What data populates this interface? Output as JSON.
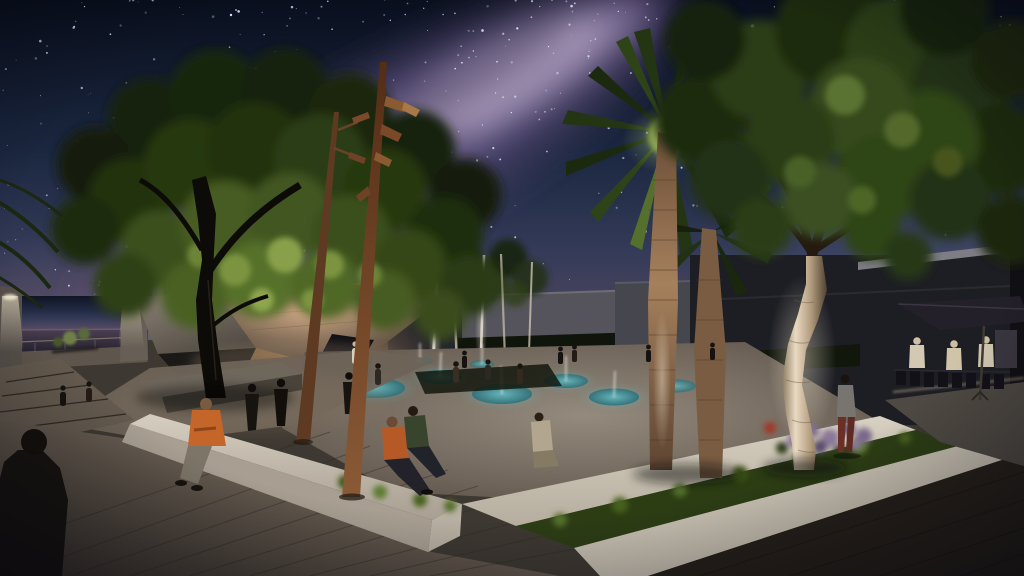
{
  "meta": {
    "description": "Night-time architectural rendering of a public plaza under a starry Milky Way sky: uplit trees and palms, a sculptural concrete pavilion with copper edge, a sunken splash-pad plaza with glowing teal pools, white concrete benches with seated people, rust-steel light poles, and a cafe terrace with an umbrella on the right"
  },
  "sky": {
    "star_count": 340,
    "band_star_count": 130,
    "star_color": "#e9edff"
  },
  "palette": {
    "sky_top": "#090f1d",
    "sky_upper": "#1b2740",
    "sky_mid": "#333a57",
    "sky_lower": "#4f4760",
    "sky_horizon": "#695a6e",
    "milky_outer": "#4e4168",
    "milky_mid": "#77639a",
    "milky_core": "#b4a2c7",
    "milky_dust": "#2b2340",
    "horizon_glow": "#8a6f80",
    "sea_top": "#4a3e52",
    "sea_bottom": "#221f2b",
    "foliage_dark": "#16220c",
    "foliage_mid": "#2c3d13",
    "foliage_lit": "#465c20",
    "foliage_hi": "#88a048",
    "pine_dark": "#1c2a10",
    "pine_mid": "#2c4018",
    "pine_hi": "#4e6626",
    "trunk_dark": "#0d0b08",
    "palm_trunk_lit": "#a5805c",
    "pine_trunk_lit": "#ead9c2",
    "copper_edge": "#d08040",
    "pavilion_warm": "#cfa985",
    "pavilion_dark": "#1b1918",
    "concrete_top": "#d6cec0",
    "concrete_face": "#a89f92",
    "step_white": "#cfc8ba",
    "plaza_mid": "#948a7d",
    "pool_teal": "#2e6f79",
    "pool_lit": "#63b7bd",
    "jet_white": "#eee9df",
    "grass_dark": "#2c3d14",
    "grass_lit": "#52702c",
    "pavement_lit": "#85786a",
    "pavement_dark": "#3c352d",
    "walkway_dark": "#262019",
    "building_gray": "#55545c",
    "building_dark": "#1d1e24",
    "parapet_light": "#7e7c85",
    "hedge_dark": "#10150b",
    "pole_rust": "#8a5a36",
    "pole_dark": "#542d16",
    "umbrella_dark": "#232029",
    "lavender": "#8a7898",
    "cone_light": "#fff3d8"
  },
  "people": {
    "foreground_silhouette": {
      "color": "#17130f"
    },
    "bench_sitter": {
      "top": "#c4652a",
      "pants": "#7d7668"
    },
    "step_sitter_orange": {
      "top": "#b55a26",
      "pants": "#23222a"
    },
    "step_sitter_green": {
      "top": "#39442c"
    },
    "plaza_sitter": {
      "top": "#b2a68e"
    },
    "standing_walker": {
      "top": "#787570",
      "pants": "#6b2f26"
    },
    "cafe_patrons": {
      "shirt": "#d3c9b2"
    },
    "walkers": {
      "color": "#17130e"
    }
  }
}
